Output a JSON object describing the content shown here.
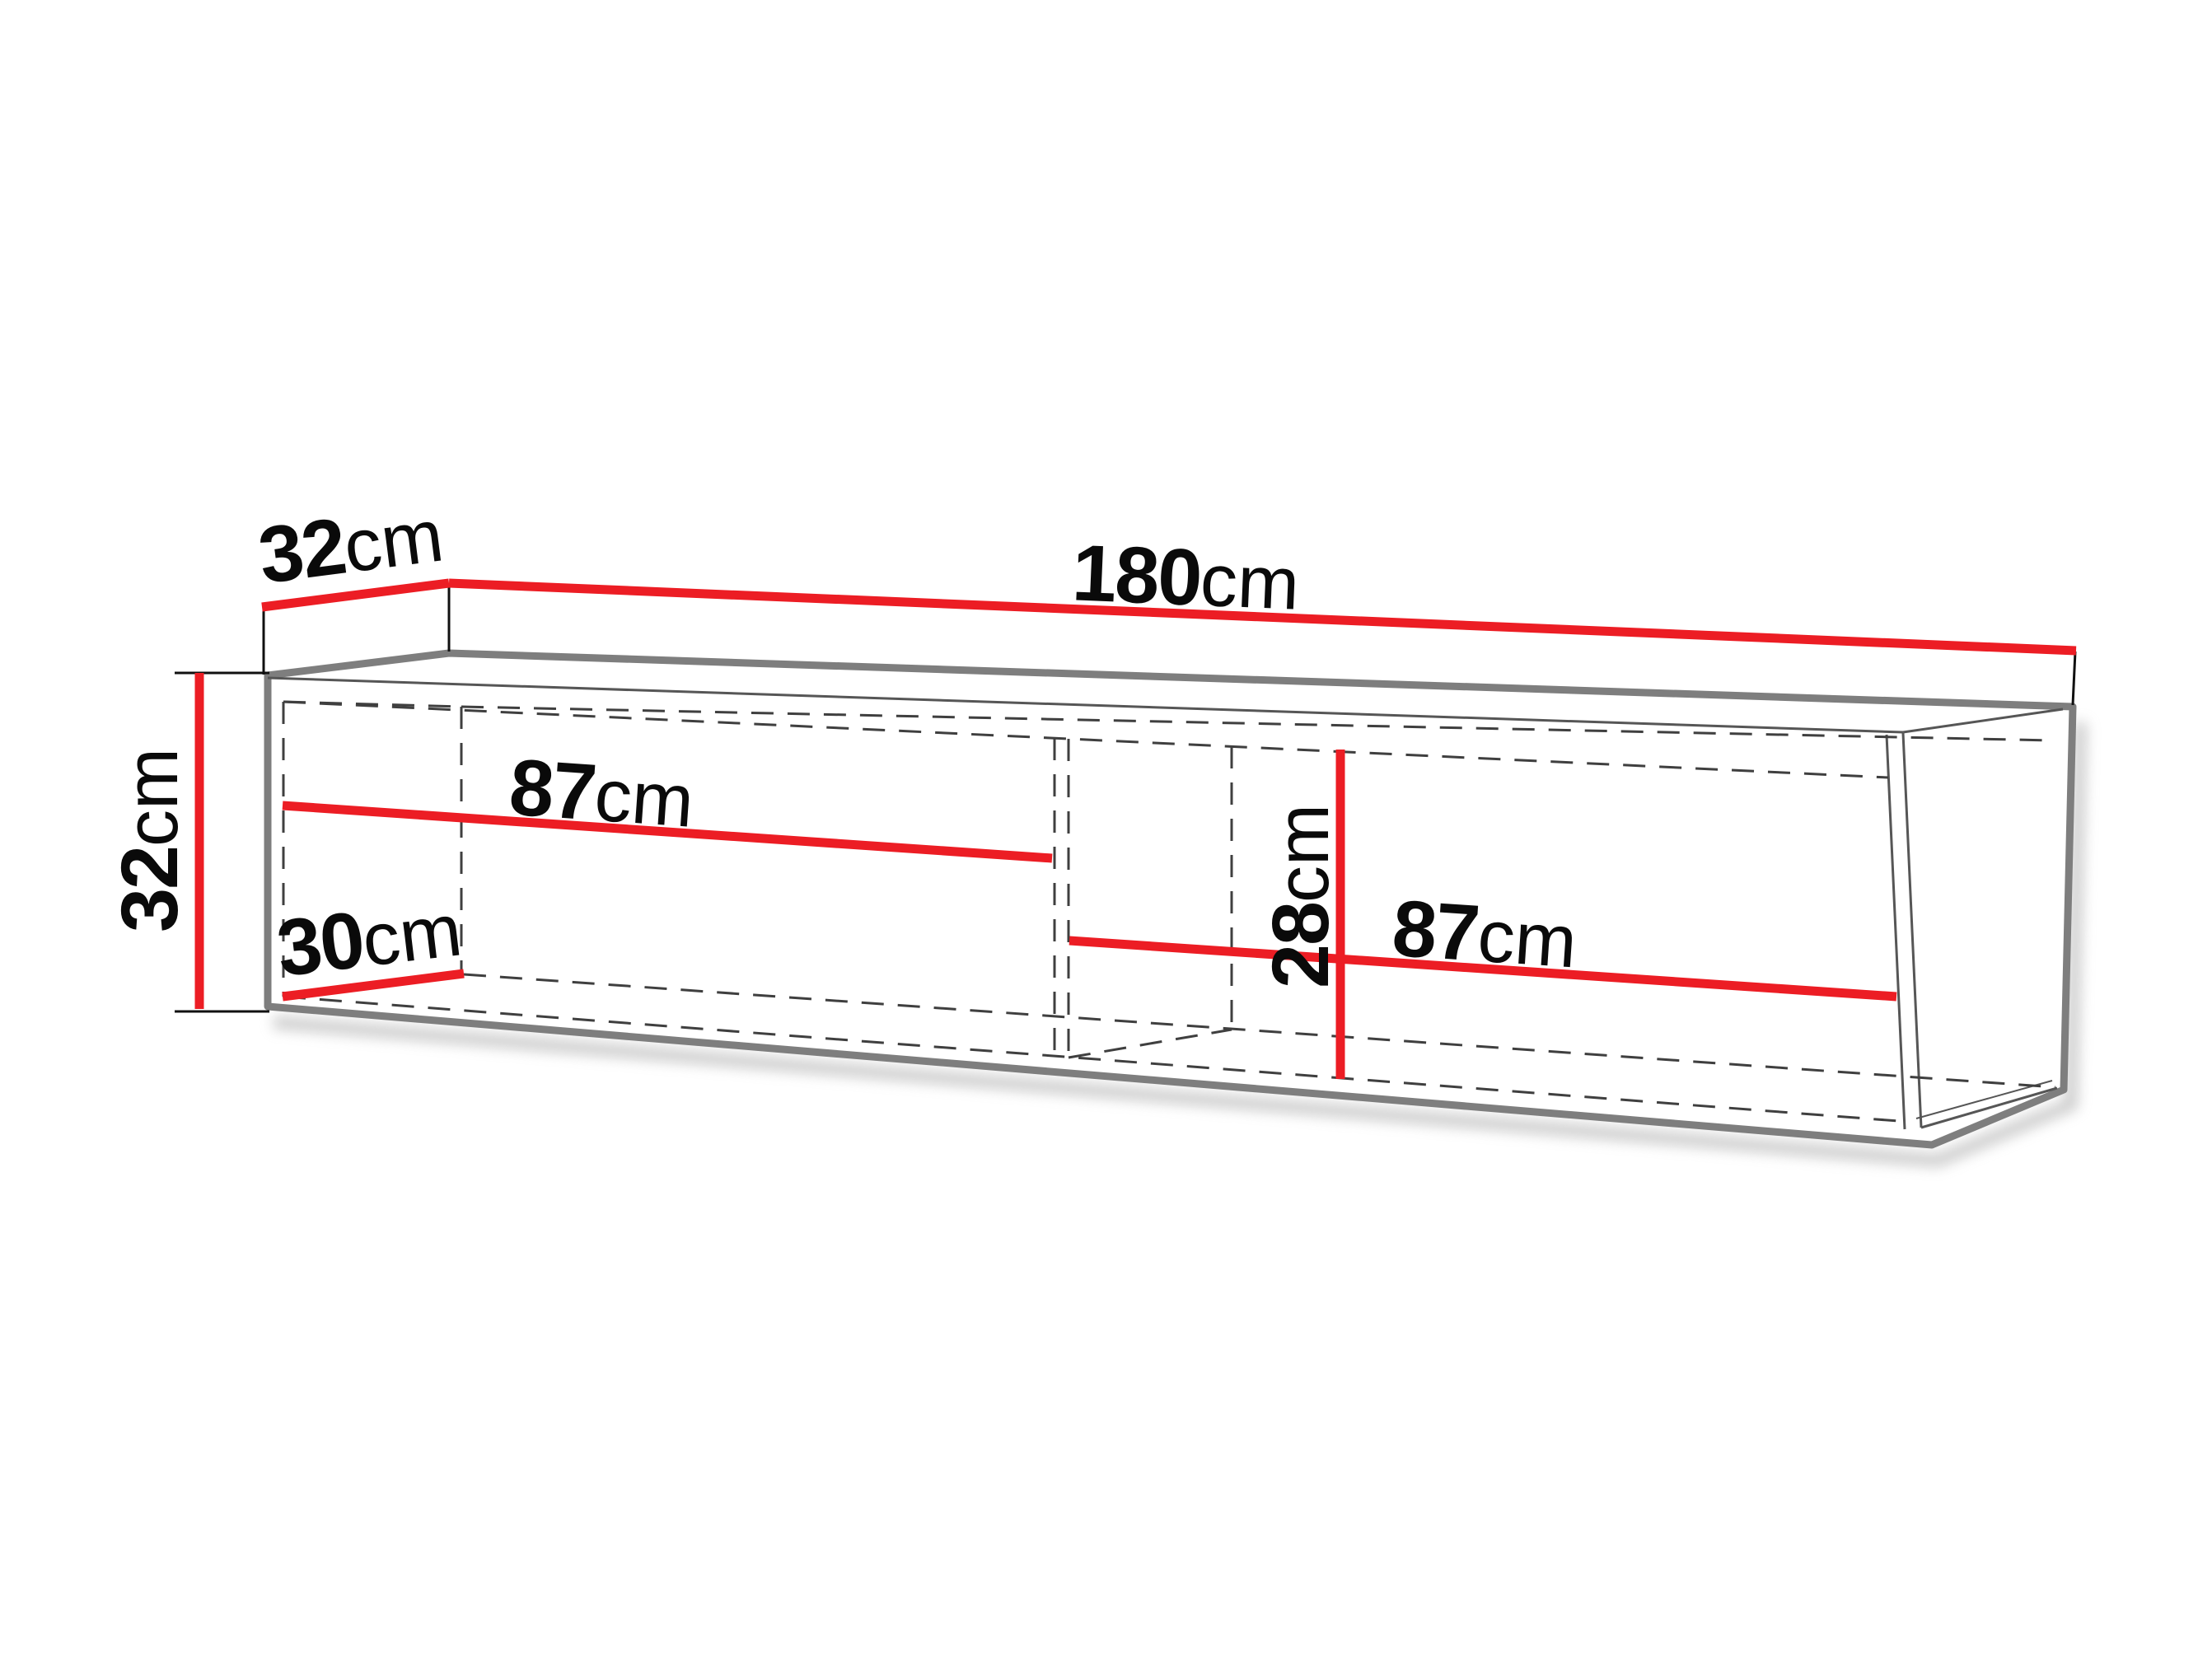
{
  "diagram": {
    "colors": {
      "dimension": "#ec1d24",
      "outline": "#7e7e7e",
      "edge_thin": "#565656",
      "hidden": "#3f3f3f",
      "label": "#0a0a0a",
      "background": "#ffffff"
    },
    "dims": {
      "depth": {
        "value": "32",
        "unit": "cm"
      },
      "width": {
        "value": "180",
        "unit": "cm"
      },
      "height": {
        "value": "32",
        "unit": "cm"
      },
      "left_compartment": {
        "value": "87",
        "unit": "cm"
      },
      "interior_depth": {
        "value": "30",
        "unit": "cm"
      },
      "interior_height": {
        "value": "28",
        "unit": "cm"
      },
      "right_compartment": {
        "value": "87",
        "unit": "cm"
      }
    }
  }
}
